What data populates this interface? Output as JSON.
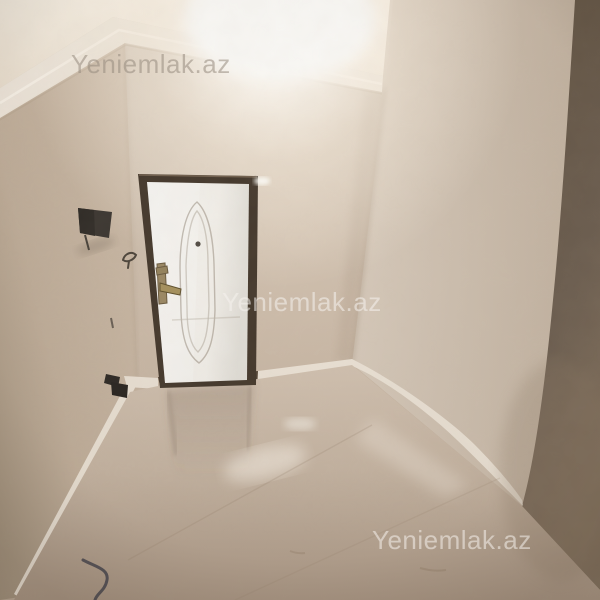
{
  "image": {
    "kind": "real-estate interior photograph",
    "description": "Empty newly renovated hallway room: beige textured plaster walls, white entry door with dark metal frame, crown molding, bright ceiling light glare, glossy beige tiled floor, white baseboards, dark shadowed wall strip on the right, small intercom box and power socket on the left wall, loose cable on the floor.",
    "width_px": 600,
    "height_px": 600
  },
  "watermarks": [
    {
      "text": "Yeniemlak.az",
      "position": "top-left"
    },
    {
      "text": "Yeniemlak.az",
      "position": "center"
    },
    {
      "text": "Yeniemlak.az",
      "position": "bottom-right"
    }
  ],
  "scene": {
    "objects": [
      "ceiling-with-crown-molding",
      "ceiling-light-glare",
      "back-wall",
      "left-wall",
      "right-wall",
      "dark-side-wall",
      "entry-door",
      "door-frame",
      "door-handle",
      "door-peephole",
      "door-panel-ornament",
      "intercom-box",
      "wall-hook-wire",
      "power-socket",
      "door-threshold",
      "baseboards",
      "glossy-tile-floor",
      "floor-cable",
      "floor-reflections"
    ]
  },
  "palette": {
    "wall": "#cdbcaa",
    "wall-light": "#d8ccbd",
    "wall-dark": "#a99a87",
    "ceiling": "#eee3d3",
    "glare": "#fffdf8",
    "molding": "#f2ebdf",
    "door-leaf": "#f3f0ea",
    "door-frame": "#463a2e",
    "handle-brass": "#9d8a66",
    "dark-wall": "#6e6052",
    "floor": "#c7b6a4",
    "floor-dark": "#ab9886",
    "baseboard": "#ece3d6",
    "threshold": "#453a2f",
    "cable": "#45454f"
  }
}
